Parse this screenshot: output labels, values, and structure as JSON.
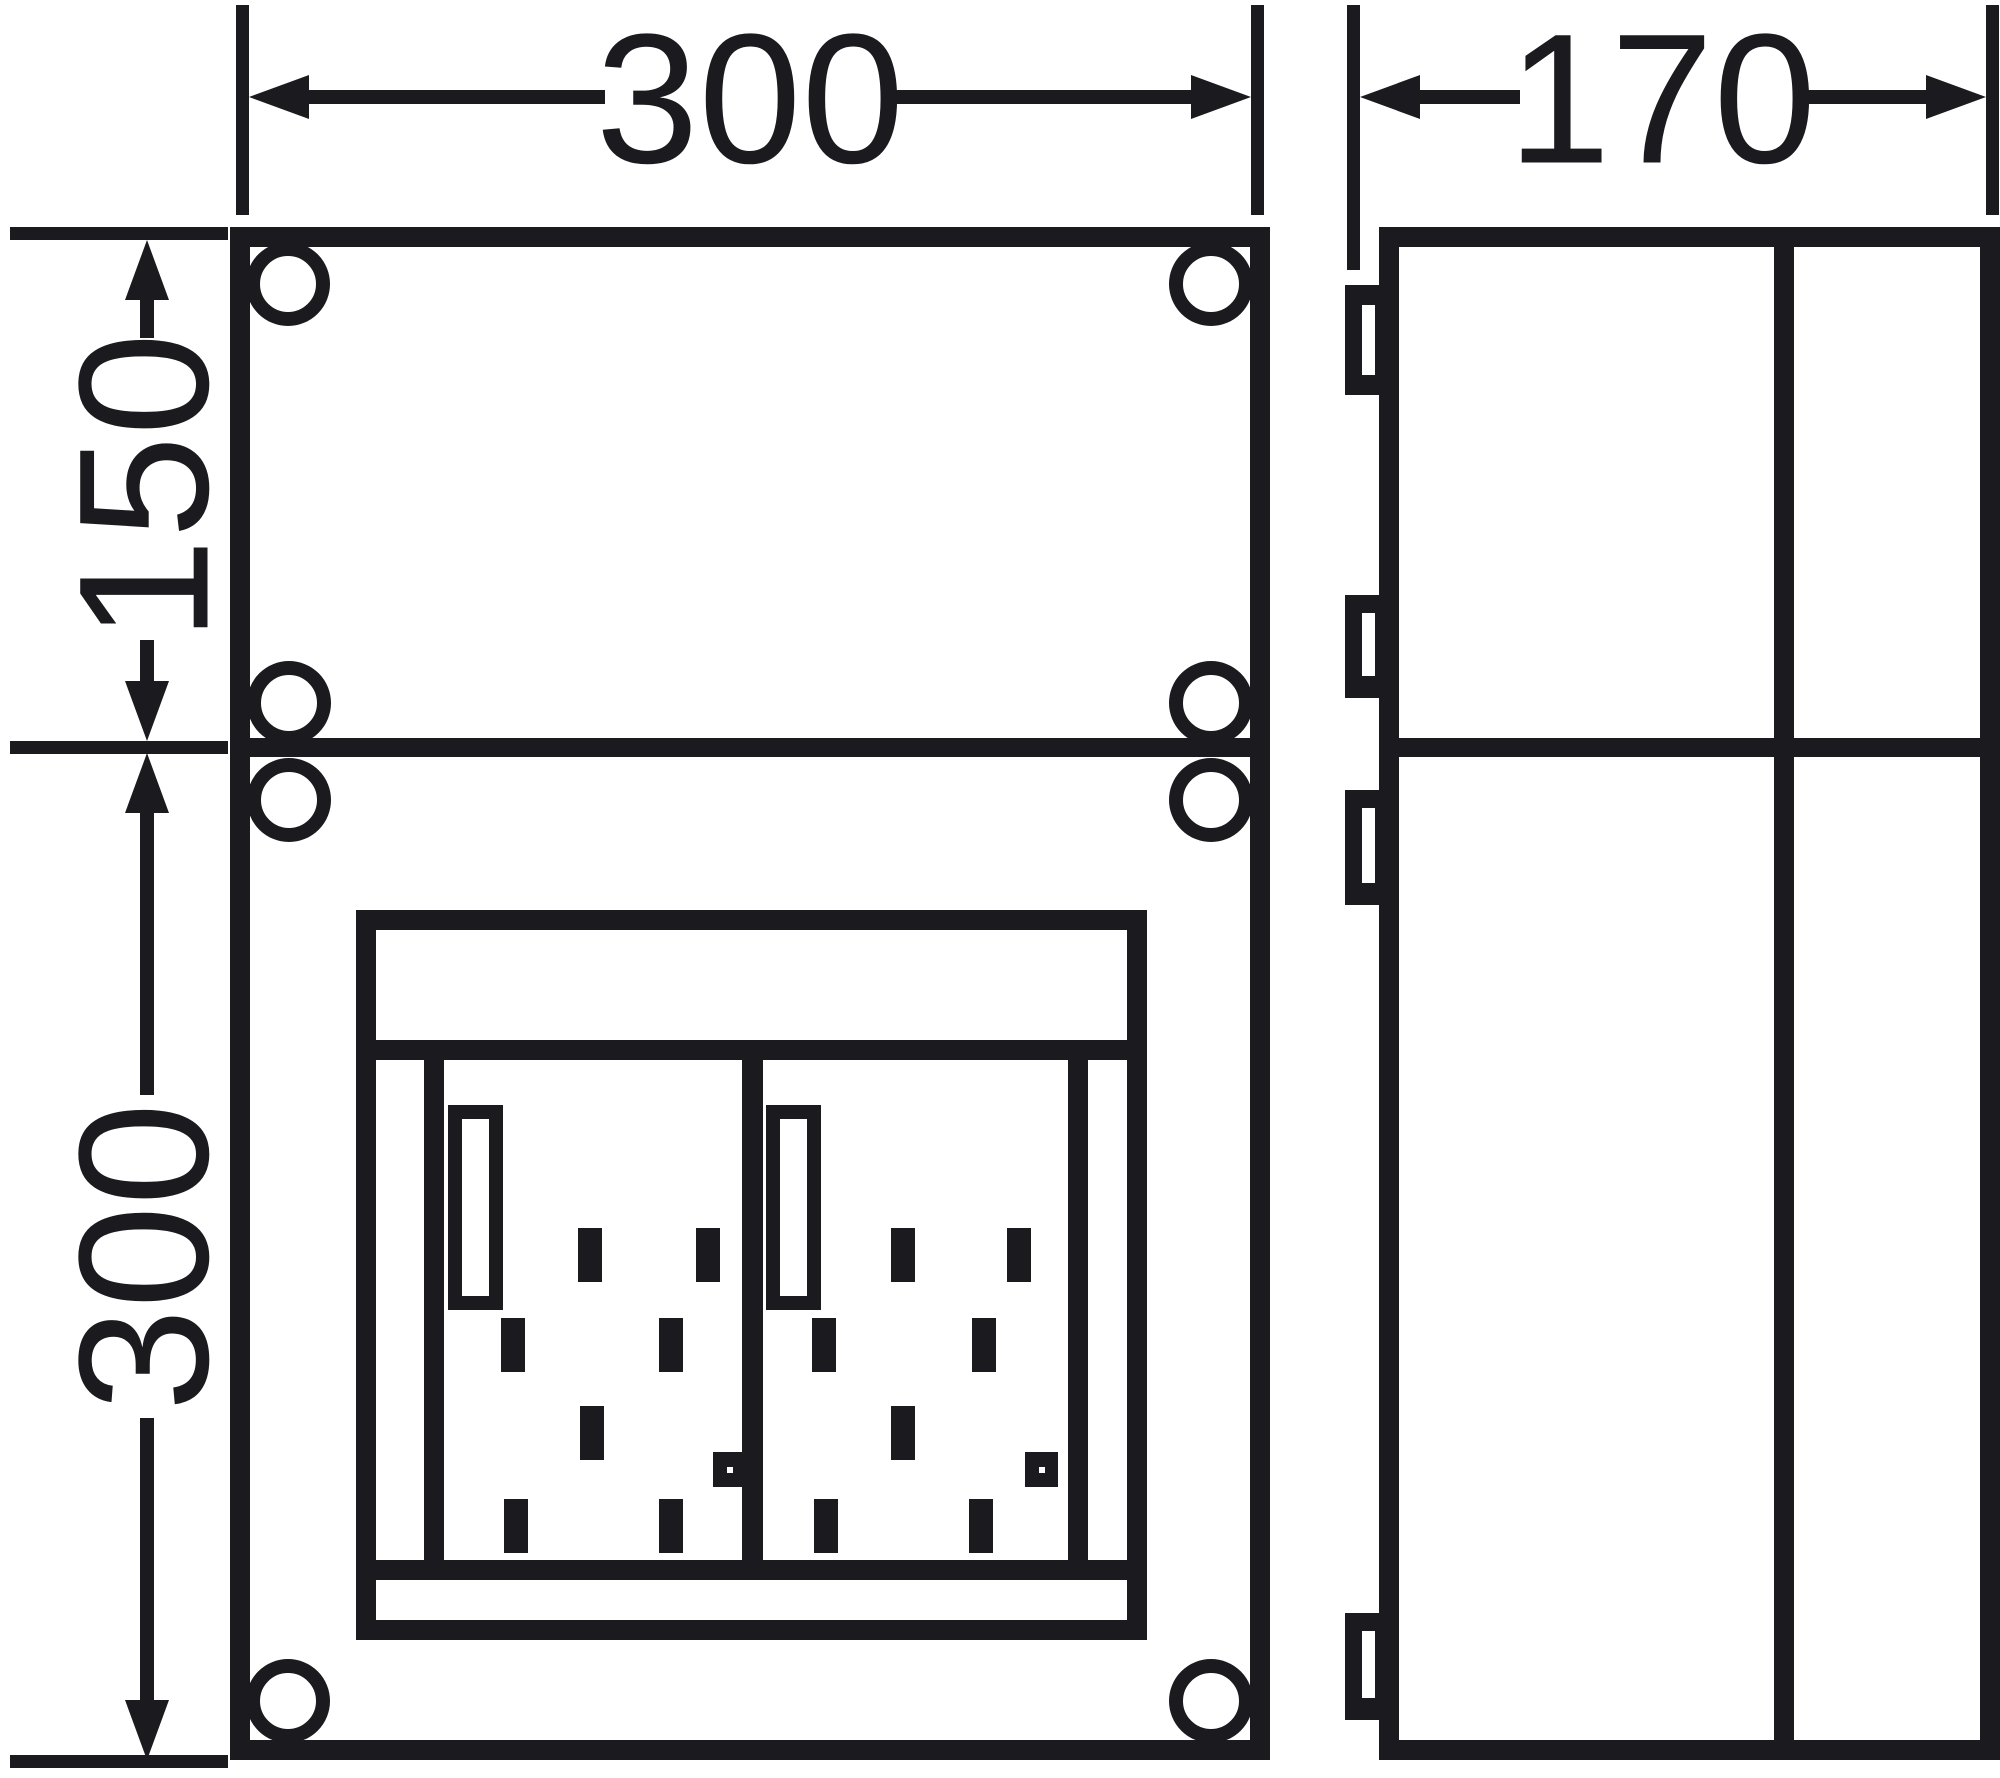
{
  "dimensions": {
    "front_width": "300",
    "depth": "170",
    "upper_section_height": "150",
    "lower_section_height": "300"
  },
  "colors": {
    "line": "#1b1b1f",
    "background": "#ffffff"
  }
}
